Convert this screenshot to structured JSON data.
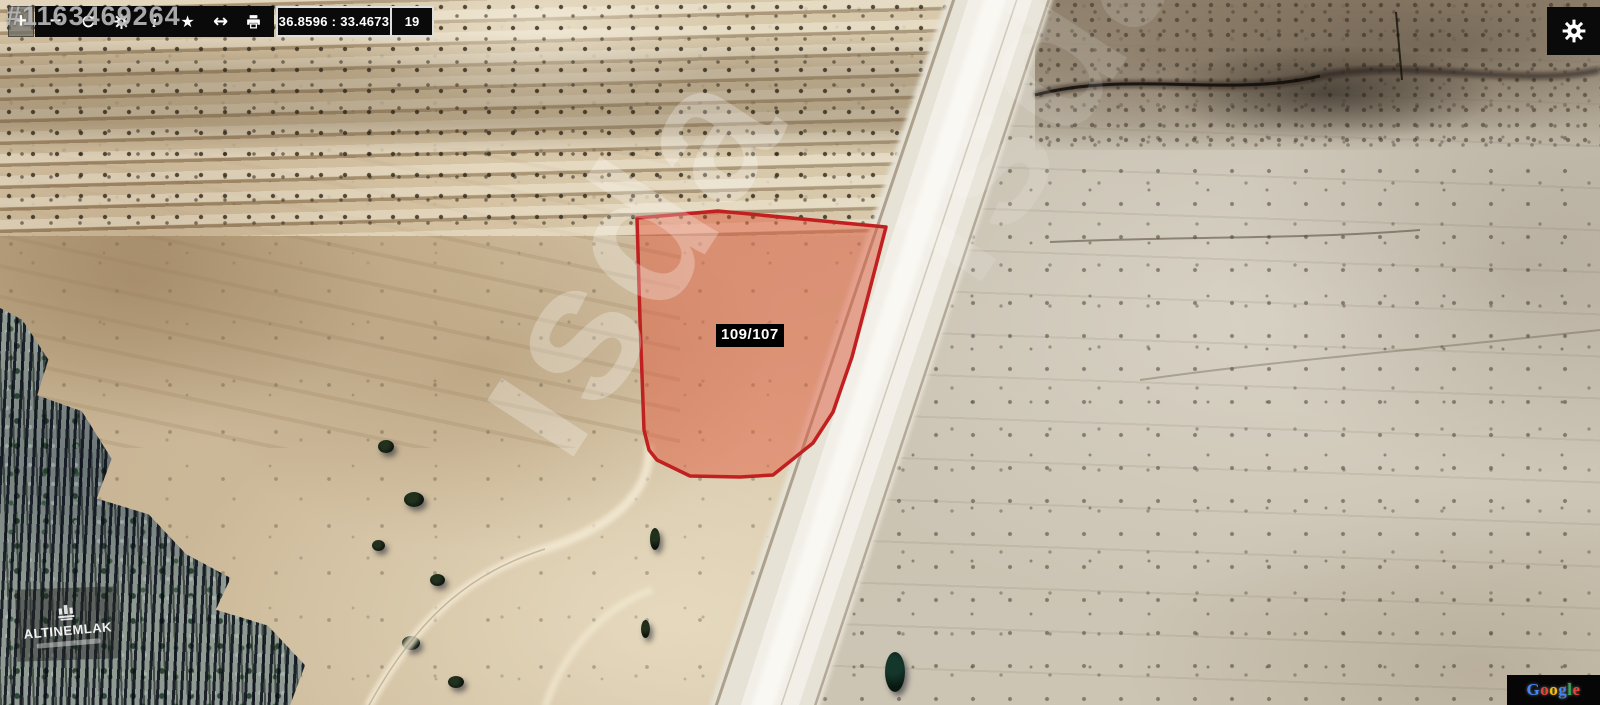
{
  "toolbar": {
    "zoom_in": "+",
    "zoom_out": "−",
    "info": "i",
    "favorite": "★",
    "measure": "↔",
    "coordinates": "36.8596 : 33.4673",
    "zoom_level": "19"
  },
  "parcel": {
    "label": "109/107",
    "points": "637,218 718,211 886,227 867,300 852,357 833,412 813,443 773,475 740,477 690,476 657,460 649,450 644,430 640,320",
    "fill": "rgba(226,83,54,0.45)",
    "stroke": "#c02020"
  },
  "watermarks": {
    "listing_id": "#1163469264",
    "diagonal_text": "ısda",
    "brand_name": "ALTINEMLAK",
    "attribution": "Google",
    "attribution_letters": [
      {
        "ch": "G",
        "color": "#4285F4"
      },
      {
        "ch": "o",
        "color": "#EA4335"
      },
      {
        "ch": "o",
        "color": "#FBBC05"
      },
      {
        "ch": "g",
        "color": "#4285F4"
      },
      {
        "ch": "l",
        "color": "#34A853"
      },
      {
        "ch": "e",
        "color": "#EA4335"
      }
    ]
  },
  "colors": {
    "toolbar_bg": "#0a0a0a",
    "coord_border": "#dedede",
    "terrain_tan": "#cfbd9e",
    "road_light": "#f2efe8",
    "forest_dark": "#0c1410"
  }
}
